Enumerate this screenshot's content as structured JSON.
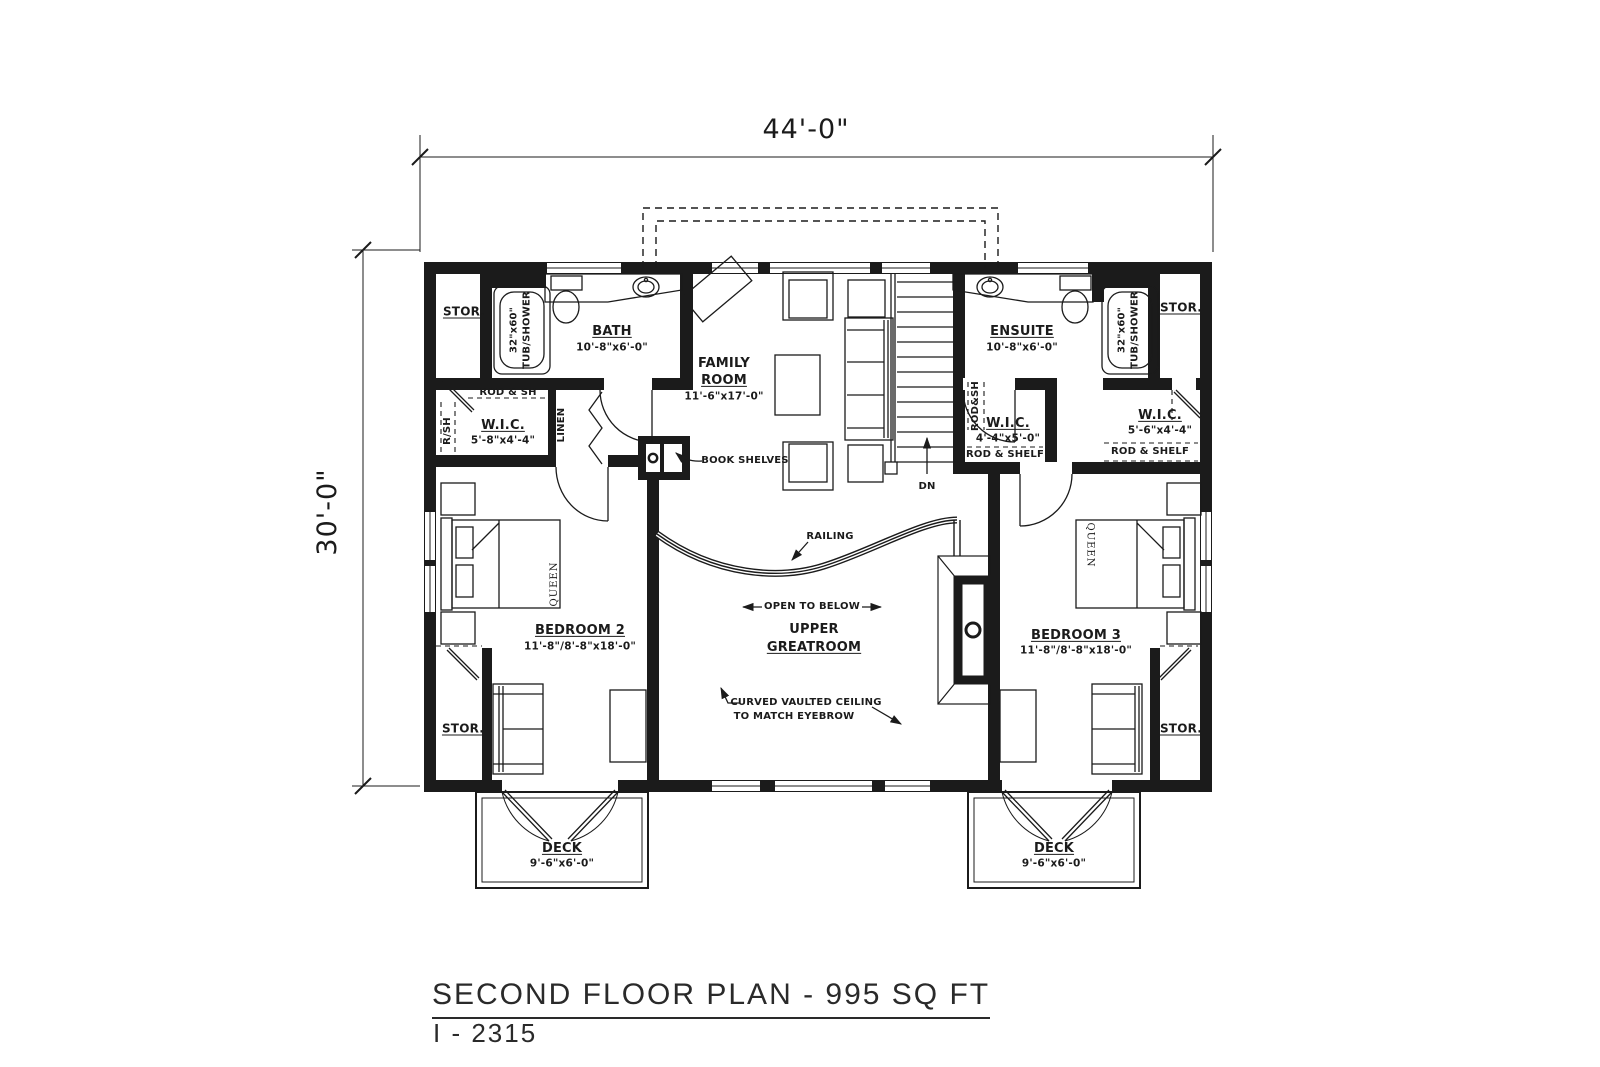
{
  "title": {
    "main": "SECOND FLOOR PLAN - 995 SQ FT",
    "plan_number": "I - 2315"
  },
  "dimensions": {
    "overall_width": "44'-0\"",
    "overall_depth": "30'-0\""
  },
  "rooms": {
    "bath": {
      "name": "BATH",
      "size": "10'-8\"x6'-0\""
    },
    "ensuite": {
      "name": "ENSUITE",
      "size": "10'-8\"x6'-0\""
    },
    "family_room": {
      "name_line1": "FAMILY",
      "name_line2": "ROOM",
      "size": "11'-6\"x17'-0\""
    },
    "upper_greatroom": {
      "name_line1": "UPPER",
      "name_line2": "GREATROOM"
    },
    "bedroom2": {
      "name": "BEDROOM 2",
      "size": "11'-8\"/8'-8\"x18'-0\""
    },
    "bedroom3": {
      "name": "BEDROOM 3",
      "size": "11'-8\"/8'-8\"x18'-0\""
    },
    "wic_left": {
      "name": "W.I.C.",
      "size": "5'-8\"x4'-4\""
    },
    "wic_center": {
      "name": "W.I.C.",
      "size": "4'-4\"x5'-0\""
    },
    "wic_right": {
      "name": "W.I.C.",
      "size": "5'-6\"x4'-4\""
    },
    "deck_left": {
      "name": "DECK",
      "size": "9'-6\"x6'-0\""
    },
    "deck_right": {
      "name": "DECK",
      "size": "9'-6\"x6'-0\""
    },
    "storage_label": "STOR."
  },
  "fixtures": {
    "tub_line1": "32\"x60\"",
    "tub_line2": "TUB/SHOWER",
    "bed_size": "QUEEN"
  },
  "annotations": {
    "rod_and_sh": "ROD & SH",
    "r_sh": "R/SH",
    "linen": "LINEN",
    "rod_sh_vertical": "ROD&SH",
    "rod_and_shelf": "ROD & SHELF",
    "book_shelves": "BOOK SHELVES",
    "railing": "RAILING",
    "open_to_below": "OPEN TO BELOW",
    "down": "DN",
    "ceiling_note_line1": "CURVED VAULTED CEILING",
    "ceiling_note_line2": "TO MATCH EYEBROW"
  },
  "colors": {
    "line": "#1b1b1b",
    "background": "#ffffff"
  }
}
